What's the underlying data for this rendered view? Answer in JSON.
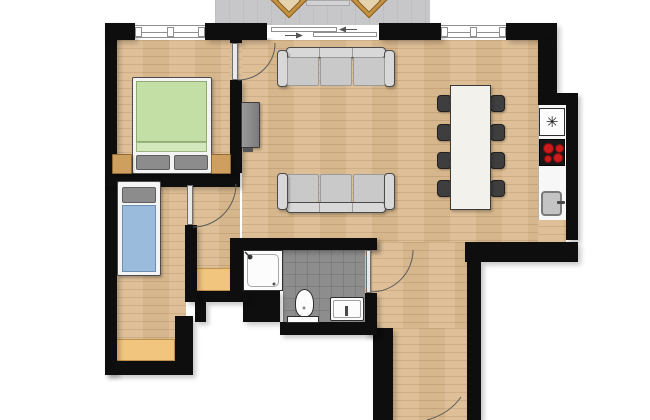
{
  "meta": {
    "type": "apartment-floor-plan",
    "view": "top-down",
    "background": "#ffffff"
  },
  "colors": {
    "wall": "#0e0e0e",
    "wood": "#dcbc92",
    "wood-seam": "rgba(120,78,35,0.16)",
    "wood-band-a": "rgba(255,255,255,0.05)",
    "wood-band-b": "rgba(120,78,35,0.06)",
    "balcony": "#c7c7c9",
    "tile": "#8d8d8d",
    "tile-line": "rgba(0,0,0,0.10)",
    "mat": "#f1c57e",
    "mat-border": "#c2924e",
    "fixture": "#fcfcfc",
    "fixture-border": "#2e2e2e",
    "sofa": "#c9c9c9",
    "sofa-arm": "#d8d8d8",
    "sofa-border": "#4a4a4a",
    "sofa-seam": "#9b9b9b",
    "bed-frame": "#f4f4f4",
    "bed-border": "#4c4c4c",
    "duvet-green": "#c3dfa6",
    "duvet-green-light": "#d3e7bd",
    "duvet-blue": "#9abbdc",
    "duvet-blue-border": "#6d8fb3",
    "pillow": "#8c8c8c",
    "pillow-border": "#5e5e5e",
    "nightstand": "#cf9f5f",
    "nightstand-border": "#906a35",
    "patio-chair": "#c89140",
    "patio-chair-border": "#7d5a1e",
    "patio-table": "#d2d2d4",
    "dining-chair": "#3e3e3e",
    "dining-chair-border": "#202020",
    "table-top": "#f3f1ec",
    "table-border": "#3a3a3a",
    "counter": "#f7f7f7",
    "counter-border": "#b5b5b5",
    "stove": "#191919",
    "burner": "#cd1a1a",
    "burner-ring": "#7e0f0f",
    "sink": "#c4c4c4",
    "sink-border": "#7a7a7a",
    "tv": "#7b7b7b",
    "tv-border": "#3c3c3c",
    "glass-line": "#8f8f8f",
    "arc": "#5c5c5c"
  },
  "kitchen": {
    "vent_icon": "✳"
  },
  "rooms": [
    {
      "id": "balcony",
      "furniture": [
        "patio-chair",
        "patio-chair",
        "patio-table"
      ],
      "floor": "concrete-gray",
      "openings": [
        "sliding-glass-door"
      ]
    },
    {
      "id": "master-bedroom",
      "furniture": [
        "double-bed-green",
        "nightstand",
        "nightstand"
      ],
      "floor": "wood",
      "openings": [
        "window",
        "door-to-living-room"
      ]
    },
    {
      "id": "second-bedroom",
      "furniture": [
        "single-bed-blue",
        "floor-mat"
      ],
      "floor": "wood",
      "openings": [
        "door-to-hall-nook"
      ]
    },
    {
      "id": "hall-nook",
      "furniture": [
        "floor-mat"
      ],
      "floor": "wood",
      "openings": []
    },
    {
      "id": "living-dining-room",
      "furniture": [
        "sofa-3-seat",
        "sofa-3-seat",
        "tv-sideboard",
        "dining-table",
        "dining-chair",
        "dining-chair",
        "dining-chair",
        "dining-chair",
        "dining-chair",
        "dining-chair",
        "dining-chair",
        "dining-chair"
      ],
      "floor": "wood",
      "openings": [
        "sliding-glass-door",
        "window"
      ]
    },
    {
      "id": "kitchen",
      "furniture": [
        "counter",
        "appliance-vent",
        "cooktop-4-burners",
        "sink"
      ],
      "floor": "wood",
      "openings": []
    },
    {
      "id": "bathroom",
      "furniture": [
        "shower",
        "toilet",
        "washbasin"
      ],
      "floor": "gray-tile",
      "openings": [
        "door-to-living-room"
      ]
    },
    {
      "id": "entry-corridor",
      "furniture": [],
      "floor": "wood",
      "openings": [
        "entry-door"
      ]
    }
  ]
}
